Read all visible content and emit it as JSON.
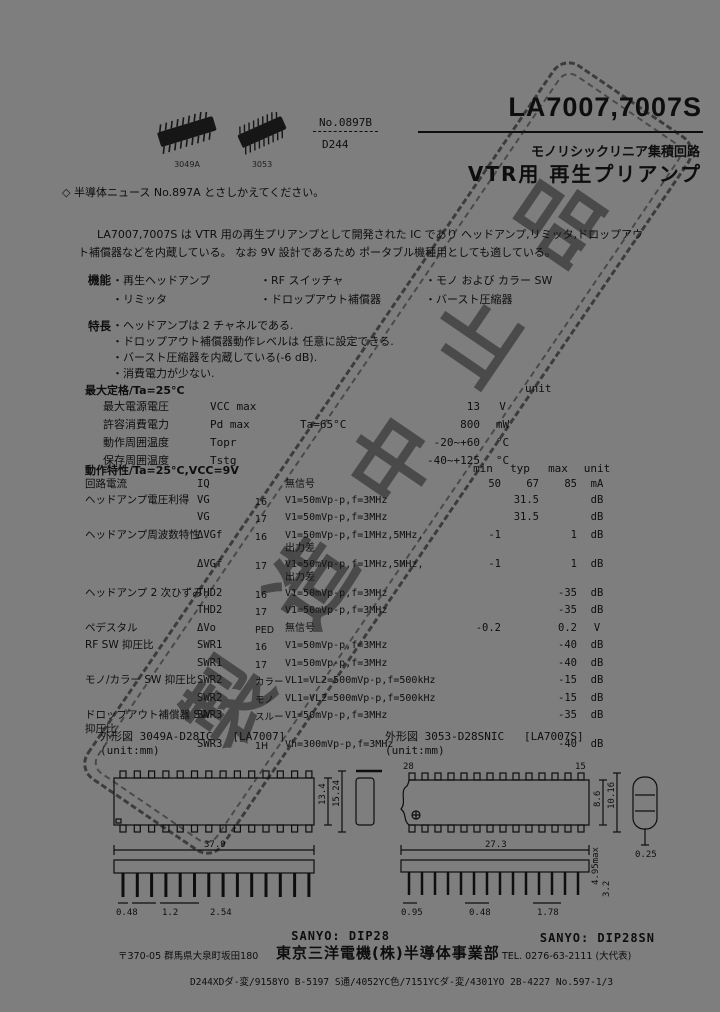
{
  "page": {
    "bg": "#7e7e7e",
    "ink": "#0e0e0e"
  },
  "watermark": {
    "text": "製造中止品"
  },
  "header": {
    "part_number": "LA7007,7007S",
    "doc_no": "No.0897B",
    "doc_code": "D244",
    "category": "モノリシックリニア集積回路",
    "subtitle": "VTR用 再生プリアンプ",
    "photo_labels": [
      "3049A",
      "3053"
    ],
    "note": "◇ 半導体ニュース No.897A とさしかえてください。"
  },
  "intro": {
    "line1": "LA7007,7007S は VTR 用の再生プリアンプとして開発された IC であり ヘッドアンプ,リミッタ,ドロップアウ",
    "line2": "ト補償器などを内蔵している。 なお 9V 設計であるため ポータブル機種用としても適している。"
  },
  "functions": {
    "label": "機能",
    "rows": [
      [
        "・再生ヘッドアンプ",
        "・RF スイッチャ",
        "・モノ および カラー SW"
      ],
      [
        "・リミッタ",
        "・ドロップアウト補償器",
        "・バースト圧縮器"
      ]
    ]
  },
  "features": {
    "label": "特長",
    "items": [
      "・ヘッドアンプは 2 チャネルである.",
      "・ドロップアウト補償器動作レベルは 任意に設定できる.",
      "・バースト圧縮器を内蔵している(-6 dB).",
      "・消費電力が少ない."
    ]
  },
  "max_ratings": {
    "title": "最大定格/Ta=25°C",
    "unit_label": "unit",
    "rows": [
      {
        "name": "最大電源電圧",
        "symbol": "VCC max",
        "cond": "",
        "value": "13",
        "unit": "V"
      },
      {
        "name": "許容消費電力",
        "symbol": "Pd max",
        "cond": "Ta=65°C",
        "value": "800",
        "unit": "mW"
      },
      {
        "name": "動作周囲温度",
        "symbol": "Topr",
        "cond": "",
        "value": "-20~+60",
        "unit": "°C"
      },
      {
        "name": "保存周囲温度",
        "symbol": "Tstg",
        "cond": "",
        "value": "-40~+125",
        "unit": "°C"
      }
    ]
  },
  "op_chars": {
    "title": "動作特性/Ta=25°C,VCC=9V",
    "cols": {
      "min": "min",
      "typ": "typ",
      "max": "max",
      "unit": "unit"
    },
    "rows": [
      {
        "name": "回路電流",
        "symbol": "IQ",
        "sub": "",
        "cond": "無信号",
        "min": "50",
        "typ": "67",
        "max": "85",
        "unit": "mA"
      },
      {
        "name": "ヘッドアンプ電圧利得",
        "symbol": "VG",
        "sub": "16",
        "cond": "V1=50mVp-p,f=3MHz",
        "typ": "31.5",
        "unit": "dB"
      },
      {
        "name": "",
        "symbol": "VG",
        "sub": "17",
        "cond": "V1=50mVp-p,f=3MHz",
        "typ": "31.5",
        "unit": "dB"
      },
      {
        "name": "ヘッドアンプ周波数特性",
        "symbol": "ΔVGf",
        "sub": "16",
        "cond": "V1=50mVp-p,f=1MHz,5MHz,",
        "cond2": "出力差",
        "min": "-1",
        "max": "1",
        "unit": "dB"
      },
      {
        "name": "",
        "symbol": "ΔVGf",
        "sub": "17",
        "cond": "V1=50mVp-p,f=1MHz,5MHz,",
        "cond2": "出力差",
        "min": "-1",
        "max": "1",
        "unit": "dB"
      },
      {
        "name": "ヘッドアンプ 2 次ひずみ",
        "symbol": "THD2",
        "sub": "16",
        "cond": "V1=50mVp-p,f=3MHz",
        "max": "-35",
        "unit": "dB"
      },
      {
        "name": "",
        "symbol": "THD2",
        "sub": "17",
        "cond": "V1=50mVp-p,f=3MHz",
        "max": "-35",
        "unit": "dB"
      },
      {
        "name": "ペデスタル",
        "symbol": "ΔVo",
        "sub": "PED",
        "cond": "無信号",
        "min": "-0.2",
        "max": "0.2",
        "unit": "V"
      },
      {
        "name": "RF SW 抑圧比",
        "symbol": "SWR1",
        "sub": "16",
        "cond": "V1=50mVp-p,f=3MHz",
        "max": "-40",
        "unit": "dB"
      },
      {
        "name": "",
        "symbol": "SWR1",
        "sub": "17",
        "cond": "V1=50mVp-p,f=3MHz",
        "max": "-40",
        "unit": "dB"
      },
      {
        "name": "モノ/カラー SW 抑圧比",
        "symbol": "SWR2",
        "sub": "カラー",
        "cond": "VL1=VL2=500mVp-p,f=500kHz",
        "max": "-15",
        "unit": "dB"
      },
      {
        "name": "",
        "symbol": "SWR2",
        "sub": "モノ",
        "cond": "VL1=VL2=500mVp-p,f=500kHz",
        "max": "-15",
        "unit": "dB"
      },
      {
        "name": "ドロップアウト補償器 SW",
        "name2": "抑圧比",
        "symbol": "SWR3",
        "sub": "スルー",
        "cond": "V1=50mVp-p,f=3MHz",
        "max": "-35",
        "unit": "dB"
      },
      {
        "name": "",
        "symbol": "SWR3",
        "sub": "1H",
        "cond": "Vh=300mVp-p,f=3MHz",
        "max": "-40",
        "unit": "dB"
      }
    ]
  },
  "outline_left": {
    "caption_prefix": "外形図",
    "code": "3049A-D28IC",
    "part": "[LA7007]",
    "unit": "(unit:mm)",
    "brand": "SANYO: DIP28",
    "dims": {
      "length": "37.9",
      "lead_w": "0.48",
      "lead_off": "1.2",
      "pitch": "2.54",
      "body_w": "13.4",
      "row_w": "15.24"
    }
  },
  "outline_right": {
    "caption_prefix": "外形図",
    "code": "3053-D28SNIC",
    "part": "[LA7007S]",
    "unit": "(unit:mm)",
    "brand": "SANYO: DIP28SN",
    "pin_tl": "28",
    "pin_tr": "15",
    "dims": {
      "length": "27.3",
      "body_w": "8.6",
      "row_w": "10.16",
      "lead_t": "0.25",
      "p1": "0.95",
      "lead_w": "0.48",
      "p3": "1.78",
      "height": "4.95max",
      "stand": "3.2"
    }
  },
  "footer": {
    "address": "〒370-05 群馬県大泉町坂田180",
    "company": "東京三洋電機(株)半導体事業部",
    "tel": "TEL. 0276-63-2111 (大代表)",
    "codes": "D244XDダ-変/9158YO B-5197 S通/4052YC色/7151YCダ-変/4301YO 2B-4227 No.597-1/3"
  }
}
